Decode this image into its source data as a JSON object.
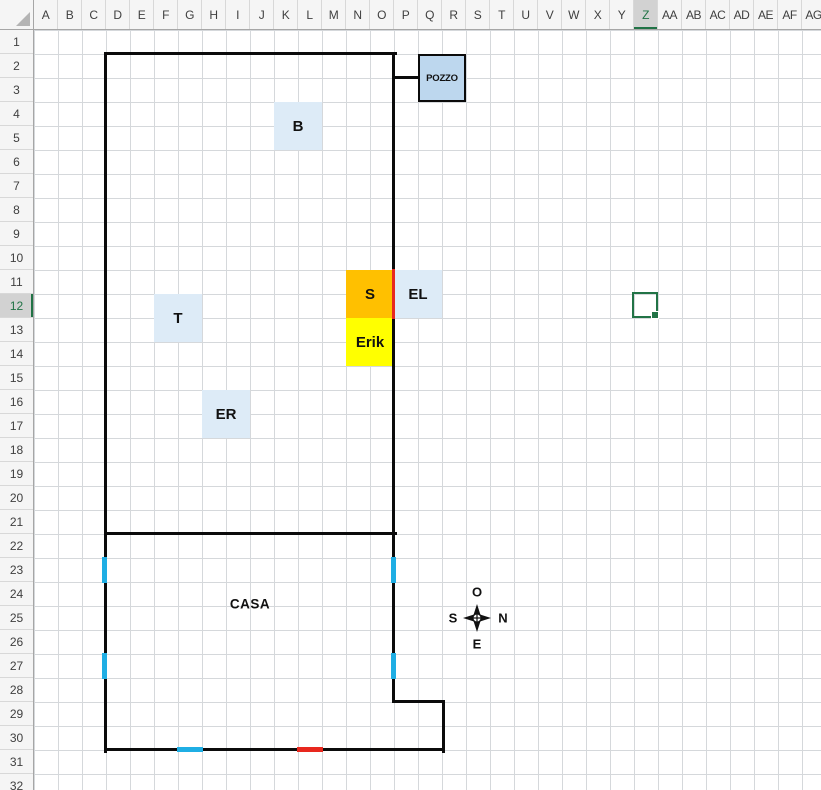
{
  "headers": {
    "columns": [
      "A",
      "B",
      "C",
      "D",
      "E",
      "F",
      "G",
      "H",
      "I",
      "J",
      "K",
      "L",
      "M",
      "N",
      "O",
      "P",
      "Q",
      "R",
      "S",
      "T",
      "U",
      "V",
      "W",
      "X",
      "Y",
      "Z",
      "AA",
      "AB",
      "AC",
      "AD",
      "AE",
      "AF",
      "AG"
    ],
    "rows": [
      "1",
      "2",
      "3",
      "4",
      "5",
      "6",
      "7",
      "8",
      "9",
      "10",
      "11",
      "12",
      "13",
      "14",
      "15",
      "16",
      "17",
      "18",
      "19",
      "20",
      "21",
      "22",
      "23",
      "24",
      "25",
      "26",
      "27",
      "28",
      "29",
      "30",
      "31",
      "32"
    ],
    "selected_column": "Z",
    "selected_row": "12"
  },
  "selection": {
    "cell": "Z12"
  },
  "drawing": {
    "pozzo_label": "POZZO",
    "b_label": "B",
    "t_label": "T",
    "er_label": "ER",
    "s_label": "S",
    "el_label": "EL",
    "erik_label": "Erik",
    "casa_label": "CASA"
  },
  "compass": {
    "top": "O",
    "right": "N",
    "left": "S",
    "bottom": "E"
  },
  "colors": {
    "light_blue_fill": "#DDEBF7",
    "pozzo_fill": "#BDD7EE",
    "orange_fill": "#FFC000",
    "yellow_fill": "#FFFF00",
    "red_accent": "#E8281E",
    "cyan_accent": "#1FAEE4",
    "selection_green": "#217346",
    "line_black": "#0b0b0b"
  }
}
